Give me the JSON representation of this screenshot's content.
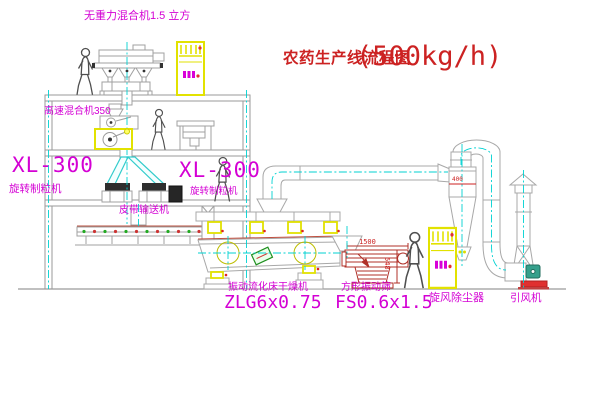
{
  "title": {
    "name": "农药生产线流程图",
    "capacity": "(500kg/h)"
  },
  "labels": {
    "gravity_mixer": "无重力混合机1.5 立方",
    "high_speed_mixer": "高速混合机350",
    "granulator_left_model": "XL-300",
    "granulator_left_name": "旋转制粒机",
    "granulator_right_model": "XL-300",
    "granulator_right_name": "旋转制粒机",
    "belt_conveyor": "皮带输送机",
    "dryer_name": "振动流化床干燥机",
    "dryer_model": "ZLG6x0.75",
    "sieve_name": "方形振动筛",
    "sieve_model": "FS0.6x1.5",
    "cyclone": "旋风除尘器",
    "fan": "引风机"
  },
  "dimensions": {
    "sieve_length": "1500",
    "sieve_height": "548",
    "cyclone_inlet": "400"
  },
  "colors": {
    "label_magenta": "#d400d4",
    "title_red": "#cc2222",
    "equipment_yellow": "#e2e200",
    "centerline_cyan": "#00d2d2",
    "line_gray": "#a8a8a8",
    "sieve_red": "#b03028",
    "motor_green": "#35a08c",
    "roller_green": "#22aa22",
    "base_red": "#e03030"
  }
}
